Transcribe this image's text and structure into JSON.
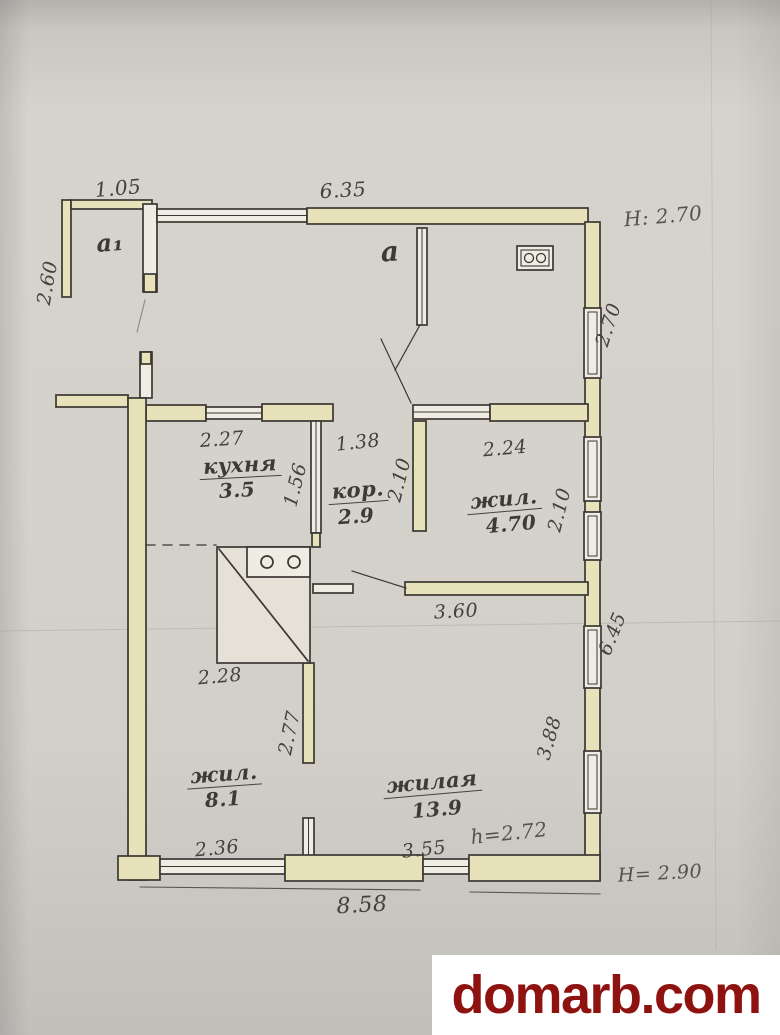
{
  "watermark": {
    "text": "domarb.com",
    "text_color": "#8e1310",
    "box_color": "#ffffff"
  },
  "plan": {
    "icons": [
      {
        "name": "stove-icon",
        "description": "masonry stove with two burners and diagonal"
      },
      {
        "name": "cooker-icon",
        "description": "small two-burner cooker in veranda"
      }
    ],
    "area_labels": [
      {
        "id": "porch-label",
        "text": "a₁",
        "x": 110,
        "y": 243,
        "size": 24,
        "rotate": -4,
        "underline": false
      },
      {
        "id": "veranda-label",
        "text": "a",
        "x": 390,
        "y": 252,
        "size": 28,
        "rotate": -4,
        "underline": false
      },
      {
        "id": "kitchen-name",
        "text": "кухня",
        "x": 240,
        "y": 466,
        "size": 21,
        "rotate": -3,
        "underline": true
      },
      {
        "id": "kitchen-area",
        "text": "3.5",
        "x": 237,
        "y": 490,
        "size": 20,
        "rotate": -3,
        "underline": false
      },
      {
        "id": "corridor-name",
        "text": "кор.",
        "x": 358,
        "y": 491,
        "size": 21,
        "rotate": -4,
        "underline": true
      },
      {
        "id": "corridor-area",
        "text": "2.9",
        "x": 356,
        "y": 516,
        "size": 20,
        "rotate": -4,
        "underline": false
      },
      {
        "id": "room-470-name",
        "text": "жил.",
        "x": 504,
        "y": 500,
        "size": 21,
        "rotate": -5,
        "underline": true
      },
      {
        "id": "room-470-area",
        "text": "4.70",
        "x": 511,
        "y": 524,
        "size": 20,
        "rotate": -5,
        "underline": false
      },
      {
        "id": "room-81-name",
        "text": "жил.",
        "x": 224,
        "y": 775,
        "size": 21,
        "rotate": -4,
        "underline": true
      },
      {
        "id": "room-81-area",
        "text": "8.1",
        "x": 223,
        "y": 799,
        "size": 20,
        "rotate": -4,
        "underline": false
      },
      {
        "id": "room-139-name",
        "text": "жилая",
        "x": 432,
        "y": 783,
        "size": 21,
        "rotate": -5,
        "underline": true
      },
      {
        "id": "room-139-area",
        "text": "13.9",
        "x": 437,
        "y": 809,
        "size": 20,
        "rotate": -5,
        "underline": false
      }
    ],
    "dimensions": [
      {
        "text": "1.05",
        "x": 118,
        "y": 188,
        "size": 20,
        "rotate": -5
      },
      {
        "text": "6.35",
        "x": 343,
        "y": 190,
        "size": 20,
        "rotate": -3
      },
      {
        "text": "2.60",
        "x": 48,
        "y": 283,
        "size": 19,
        "rotate": -80
      },
      {
        "text": "2.70",
        "x": 609,
        "y": 325,
        "size": 19,
        "rotate": -72
      },
      {
        "text": "2.27",
        "x": 222,
        "y": 440,
        "size": 19,
        "rotate": -4
      },
      {
        "text": "1.38",
        "x": 358,
        "y": 443,
        "size": 19,
        "rotate": -6
      },
      {
        "text": "2.24",
        "x": 505,
        "y": 449,
        "size": 19,
        "rotate": -5
      },
      {
        "text": "1.56",
        "x": 296,
        "y": 485,
        "size": 19,
        "rotate": -76
      },
      {
        "text": "2.10",
        "x": 400,
        "y": 480,
        "size": 19,
        "rotate": -76
      },
      {
        "text": "2.10",
        "x": 560,
        "y": 510,
        "size": 19,
        "rotate": -76
      },
      {
        "text": "3.60",
        "x": 456,
        "y": 612,
        "size": 19,
        "rotate": -3
      },
      {
        "text": "2.28",
        "x": 220,
        "y": 677,
        "size": 19,
        "rotate": -5
      },
      {
        "text": "6.45",
        "x": 613,
        "y": 634,
        "size": 19,
        "rotate": -68
      },
      {
        "text": "2.77",
        "x": 290,
        "y": 733,
        "size": 19,
        "rotate": -78
      },
      {
        "text": "3.88",
        "x": 550,
        "y": 738,
        "size": 19,
        "rotate": -74
      },
      {
        "text": "2.36",
        "x": 217,
        "y": 849,
        "size": 19,
        "rotate": -5
      },
      {
        "text": "3.55",
        "x": 424,
        "y": 850,
        "size": 19,
        "rotate": -6
      },
      {
        "text": "8.58",
        "x": 362,
        "y": 906,
        "size": 22,
        "rotate": -3
      }
    ],
    "height_notes": [
      {
        "text": "H: 2.70",
        "x": 663,
        "y": 216,
        "size": 20,
        "rotate": -5
      },
      {
        "text": "h=2.72",
        "x": 509,
        "y": 833,
        "size": 20,
        "rotate": -6
      },
      {
        "text": "H= 2.90",
        "x": 660,
        "y": 874,
        "size": 19,
        "rotate": -3
      }
    ]
  }
}
